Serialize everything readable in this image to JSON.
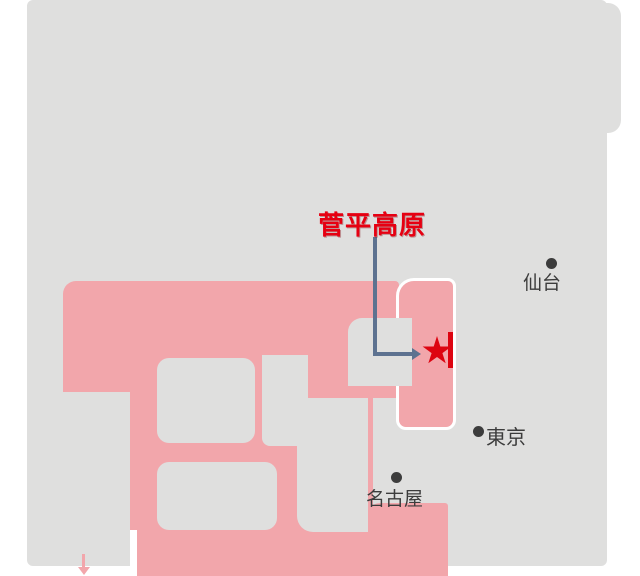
{
  "map": {
    "poi": {
      "label": "菅平高原"
    },
    "cities": {
      "sendai": {
        "name": "仙台"
      },
      "tokyo": {
        "name": "東京"
      },
      "nagoya": {
        "name": "名古屋"
      }
    },
    "colors": {
      "sea": "#ffffff",
      "land": "#dfdfde",
      "highlight_pink": "#f2a6ab",
      "marker_red": "#dd0411",
      "label_red": "#e60012",
      "leader_blue": "#5d7290",
      "text": "#3c3c3c"
    }
  }
}
